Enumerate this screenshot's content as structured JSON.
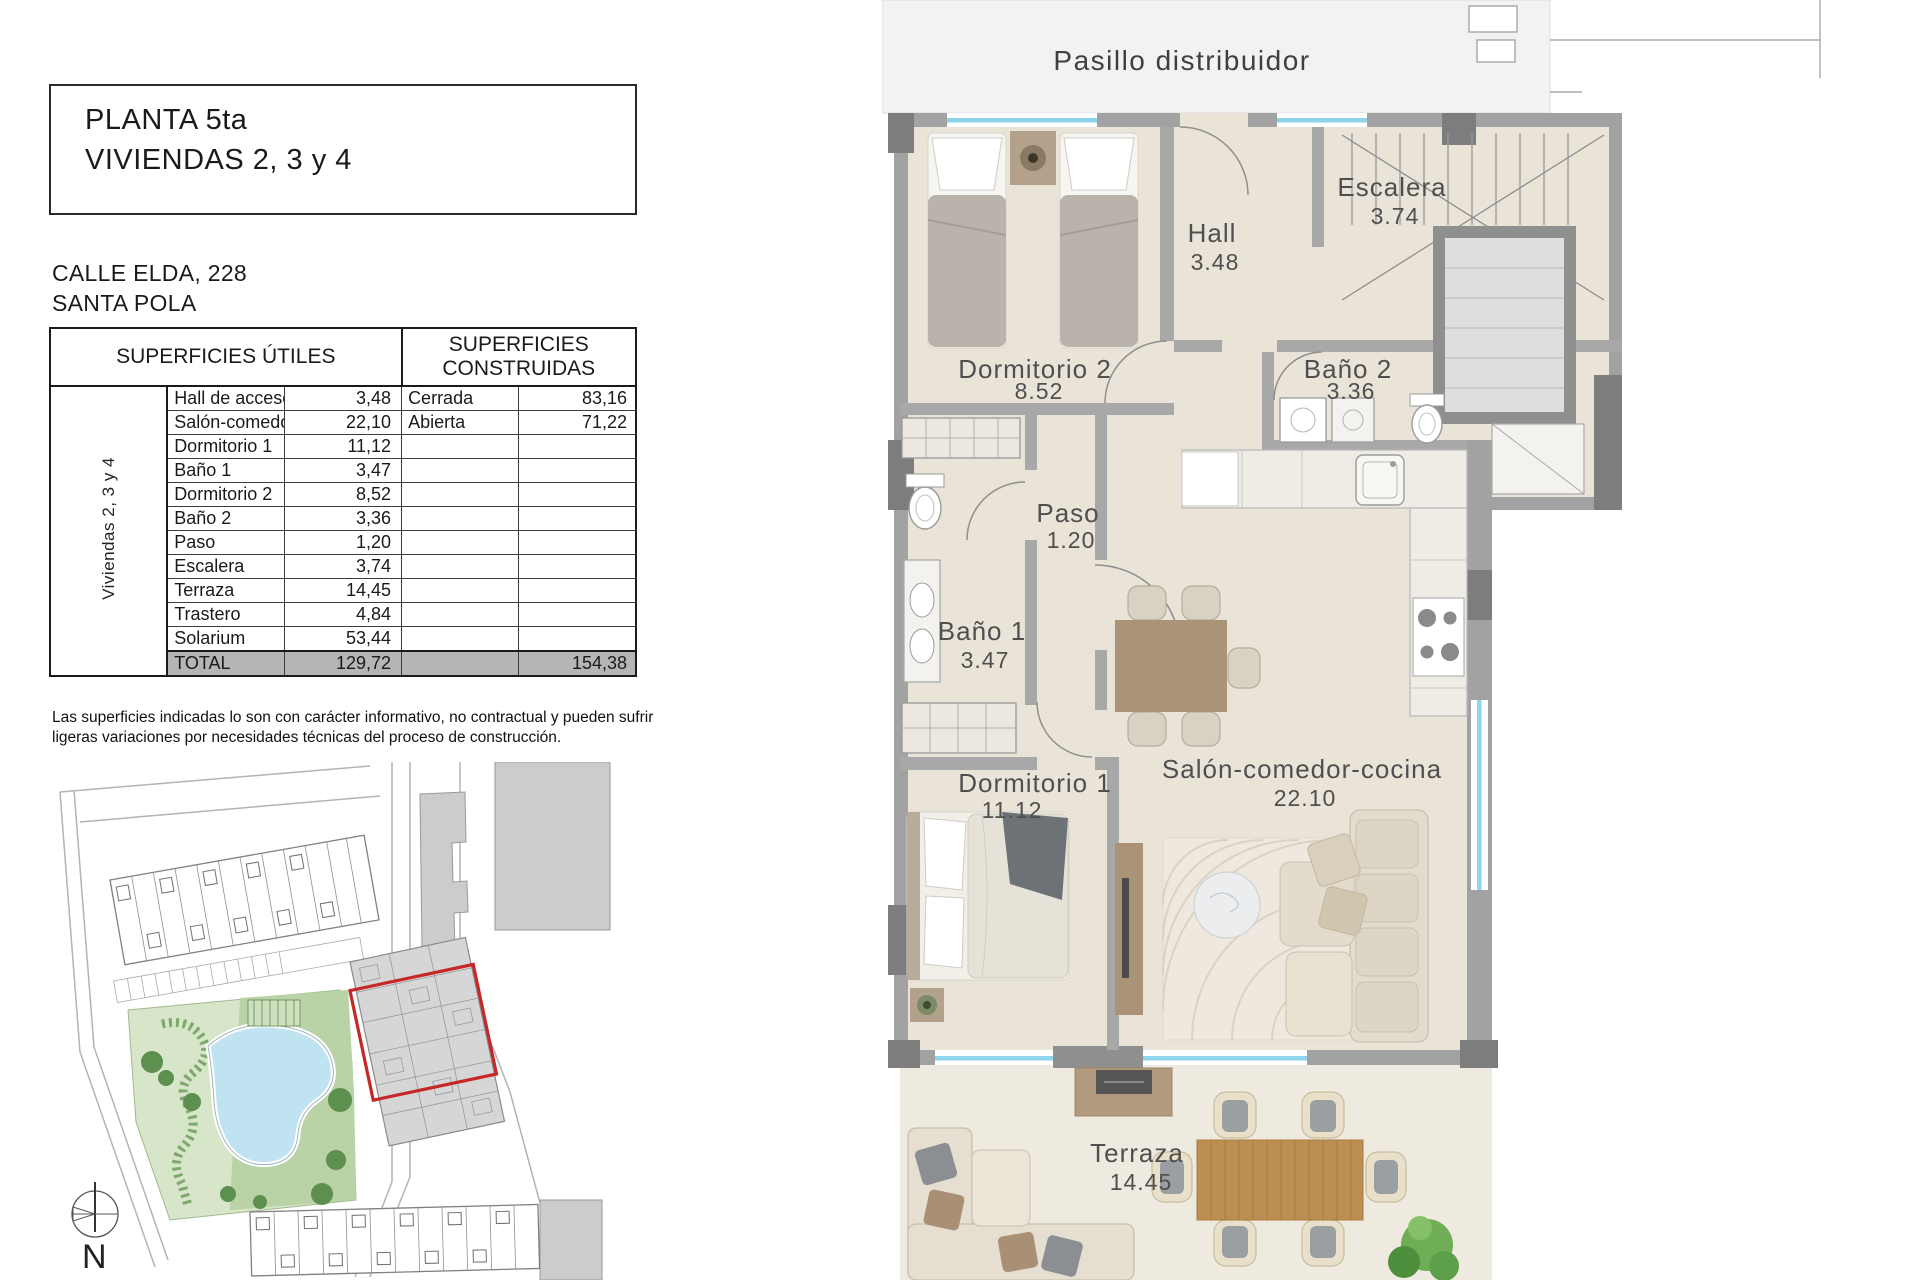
{
  "header": {
    "title_line1": "PLANTA 5ta",
    "title_line2": "VIVIENDAS 2, 3 y 4",
    "address_line1": "CALLE ELDA, 228",
    "address_line2": "SANTA POLA"
  },
  "table": {
    "group_label": "Viviendas 2, 3 y 4",
    "col_utiles": "SUPERFICIES ÚTILES",
    "col_construidas_line1": "SUPERFICIES",
    "col_construidas_line2": "CONSTRUIDAS",
    "rows": [
      {
        "name": "Hall de acceso",
        "value": "3,48",
        "built_name": "Cerrada",
        "built_value": "83,16"
      },
      {
        "name": "Salón-comedor-cocina",
        "value": "22,10",
        "built_name": "Abierta",
        "built_value": "71,22"
      },
      {
        "name": "Dormitorio 1",
        "value": "11,12",
        "built_name": "",
        "built_value": ""
      },
      {
        "name": "Baño 1",
        "value": "3,47",
        "built_name": "",
        "built_value": ""
      },
      {
        "name": "Dormitorio 2",
        "value": "8,52",
        "built_name": "",
        "built_value": ""
      },
      {
        "name": "Baño 2",
        "value": "3,36",
        "built_name": "",
        "built_value": ""
      },
      {
        "name": "Paso",
        "value": "1,20",
        "built_name": "",
        "built_value": ""
      },
      {
        "name": "Escalera",
        "value": "3,74",
        "built_name": "",
        "built_value": ""
      },
      {
        "name": "Terraza",
        "value": "14,45",
        "built_name": "",
        "built_value": ""
      },
      {
        "name": "Trastero",
        "value": "4,84",
        "built_name": "",
        "built_value": ""
      },
      {
        "name": "Solarium",
        "value": "53,44",
        "built_name": "",
        "built_value": ""
      }
    ],
    "total": {
      "label": "TOTAL",
      "value": "129,72",
      "built_value": "154,38"
    }
  },
  "disclaimer_line1": "Las superficies indicadas lo son con carácter informativo, no contractual y pueden sufrir",
  "disclaimer_line2": "ligeras variaciones por necesidades técnicas del proceso de construcción.",
  "site_plan": {
    "north_label": "N"
  },
  "floor_plan": {
    "rooms": [
      {
        "label": "Pasillo distribuidor",
        "area": ""
      },
      {
        "label": "Escalera",
        "area": "3.74"
      },
      {
        "label": "Hall",
        "area": "3.48"
      },
      {
        "label": "Dormitorio 2",
        "area": "8.52"
      },
      {
        "label": "Baño 2",
        "area": "3.36"
      },
      {
        "label": "Paso",
        "area": "1.20"
      },
      {
        "label": "Baño 1",
        "area": "3.47"
      },
      {
        "label": "Dormitorio 1",
        "area": "11.12"
      },
      {
        "label": "Salón-comedor-cocina",
        "area": "22.10"
      },
      {
        "label": "Terraza",
        "area": "14.45"
      }
    ]
  },
  "colors": {
    "floor": "#eae4d8",
    "terrace_floor": "#efeadf",
    "wall": "#a2a2a2",
    "pillar": "#7d7d7d",
    "window": "#8fd3ec",
    "pasillo": "#f2f2f2",
    "wood": "#ab9377",
    "terrace_wood": "#bc8e52",
    "green": "#b9d2a6",
    "pool": "#bfe3f1",
    "highlight_red": "#c62828",
    "total_row": "#b5b5b5"
  }
}
